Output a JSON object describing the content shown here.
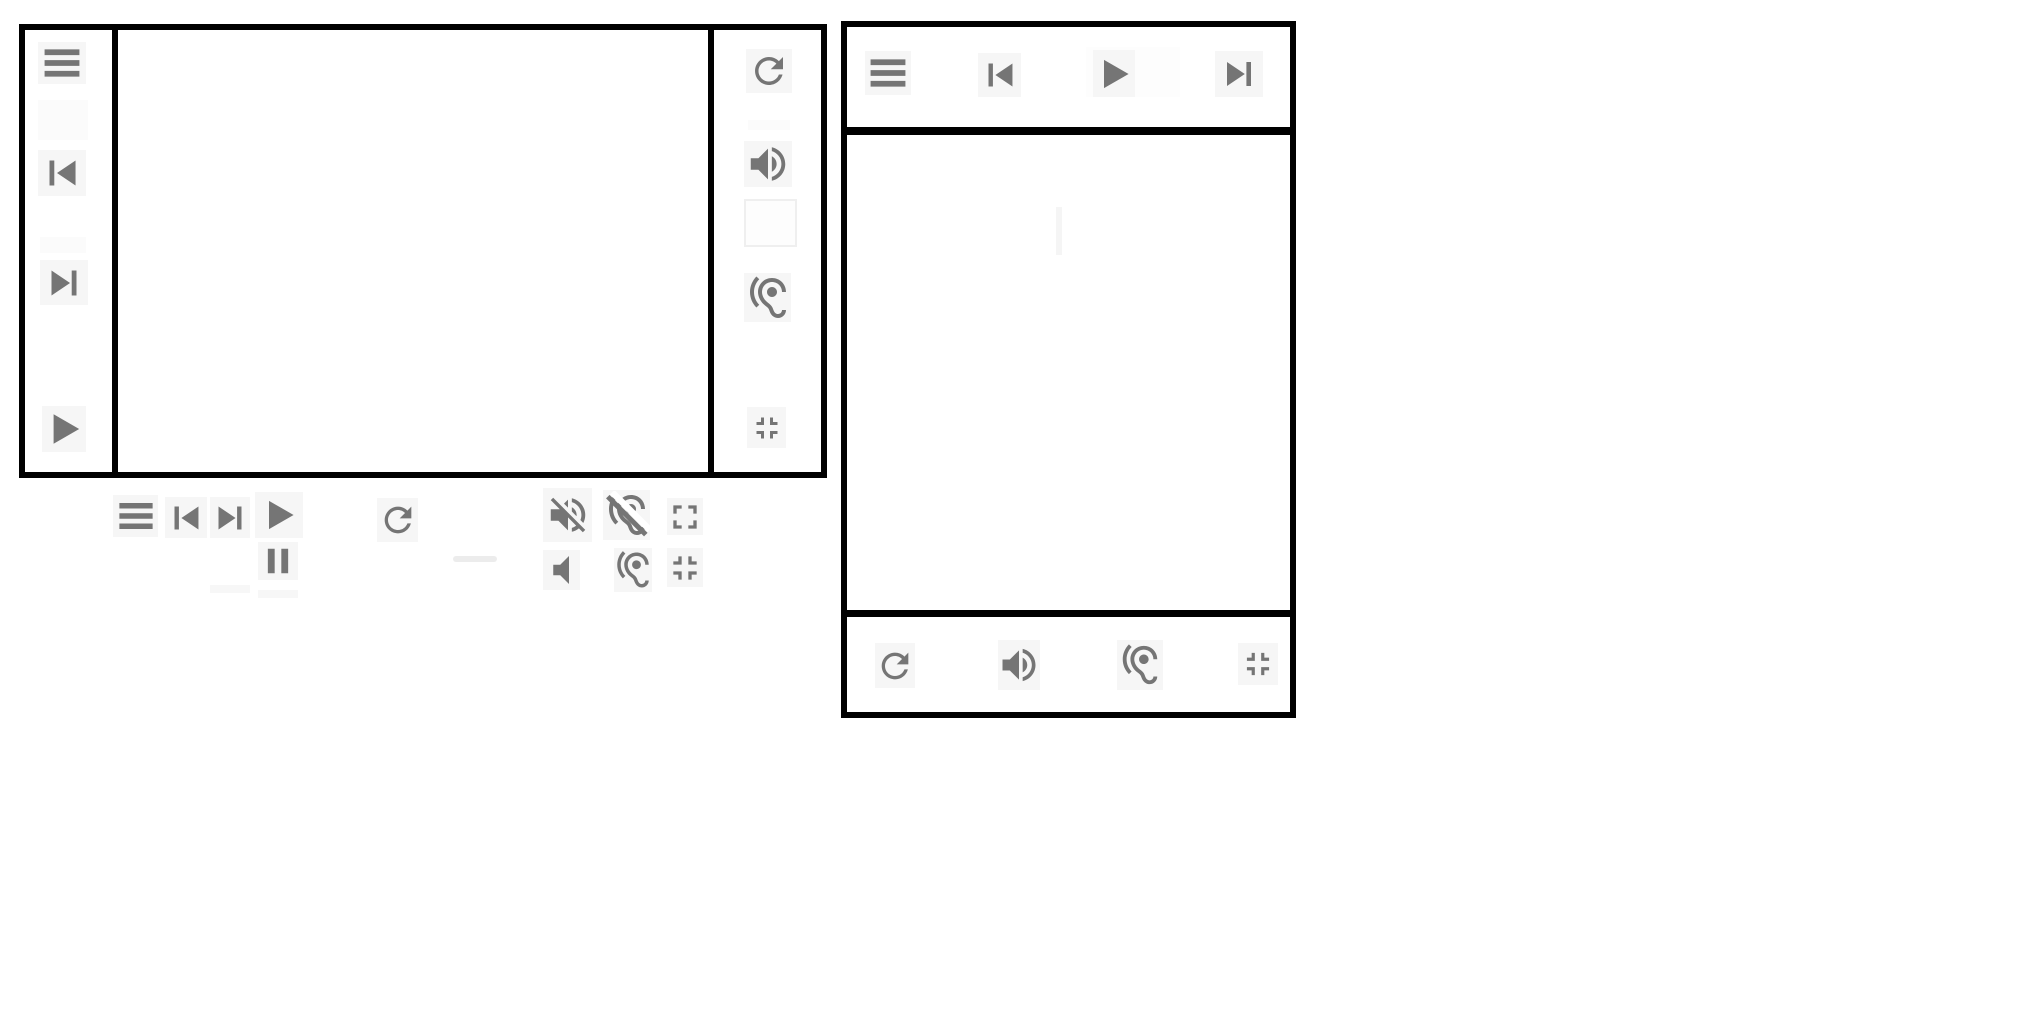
{
  "app": {
    "description": "Two bordered media player panels with gray control icons and a floating control cluster",
    "visible_text": []
  },
  "colors": {
    "background": "#ffffff",
    "panel_border": "#000000",
    "icon": "#757575",
    "button_tile": "#f6f6f6",
    "empty_tile": "#fdfdfd",
    "empty_tile_edge": "#efefef",
    "artifact_tile": "#f7f7f7",
    "faint_tile": "#fbfbfb",
    "dash": "#ececec",
    "faint_line": "#f5f5f5"
  },
  "left_player": {
    "name": "left-player-panel",
    "left_toolbar": {
      "name": "left-toolbar",
      "buttons": [
        {
          "id": "lp-menu",
          "icon": "menu",
          "name": "menu-button"
        },
        {
          "id": "lp-prev",
          "icon": "skip-previous",
          "name": "skip-previous-button"
        },
        {
          "id": "lp-next",
          "icon": "skip-next",
          "name": "skip-next-button"
        },
        {
          "id": "lp-play",
          "icon": "play",
          "name": "play-button"
        }
      ]
    },
    "right_toolbar": {
      "name": "right-toolbar",
      "buttons": [
        {
          "id": "rp-refresh",
          "icon": "refresh",
          "name": "refresh-button"
        },
        {
          "id": "rp-volume",
          "icon": "volume-up",
          "name": "volume-up-button"
        },
        {
          "id": "rp-empty",
          "icon": "none",
          "name": "empty-button"
        },
        {
          "id": "rp-hearing",
          "icon": "hearing",
          "name": "hearing-button"
        },
        {
          "id": "rp-collapse",
          "icon": "fullscreen-exit",
          "name": "fullscreen-exit-button"
        }
      ]
    }
  },
  "floating_controls": {
    "name": "floating-controls",
    "row1": [
      {
        "id": "f-menu",
        "icon": "menu",
        "name": "menu-button"
      },
      {
        "id": "f-prev",
        "icon": "skip-previous",
        "name": "skip-previous-button"
      },
      {
        "id": "f-next",
        "icon": "skip-next",
        "name": "skip-next-button"
      },
      {
        "id": "f-play",
        "icon": "play",
        "name": "play-button"
      },
      {
        "id": "f-refresh",
        "icon": "refresh",
        "name": "refresh-button"
      },
      {
        "id": "f-voloff",
        "icon": "volume-off",
        "name": "volume-off-button"
      },
      {
        "id": "f-hearoff",
        "icon": "hearing-disabled",
        "name": "hearing-disabled-button"
      },
      {
        "id": "f-fullscreen",
        "icon": "fullscreen",
        "name": "fullscreen-button"
      }
    ],
    "row2": [
      {
        "id": "f-pause",
        "icon": "pause",
        "name": "pause-button"
      },
      {
        "id": "f-volmute",
        "icon": "volume-mute",
        "name": "volume-mute-button"
      },
      {
        "id": "f-hearing",
        "icon": "hearing",
        "name": "hearing-button"
      },
      {
        "id": "f-collapse",
        "icon": "fullscreen-exit",
        "name": "fullscreen-exit-button"
      }
    ]
  },
  "right_player": {
    "name": "right-player-panel",
    "top_toolbar": {
      "name": "top-toolbar",
      "buttons": [
        {
          "id": "rt-menu",
          "icon": "menu",
          "name": "menu-button"
        },
        {
          "id": "rt-prev",
          "icon": "skip-previous",
          "name": "skip-previous-button"
        },
        {
          "id": "rt-play",
          "icon": "play",
          "name": "play-button"
        },
        {
          "id": "rt-next",
          "icon": "skip-next",
          "name": "skip-next-button"
        }
      ]
    },
    "bottom_toolbar": {
      "name": "bottom-toolbar",
      "buttons": [
        {
          "id": "rb-refresh",
          "icon": "refresh",
          "name": "refresh-button"
        },
        {
          "id": "rb-volume",
          "icon": "volume-up",
          "name": "volume-up-button"
        },
        {
          "id": "rb-hearing",
          "icon": "hearing",
          "name": "hearing-button"
        },
        {
          "id": "rb-collapse",
          "icon": "fullscreen-exit",
          "name": "fullscreen-exit-button"
        }
      ]
    }
  },
  "artifacts": [
    {
      "id": "a-tile-1",
      "name": "ui-artifact-tile"
    },
    {
      "id": "a-tile-2",
      "name": "ui-artifact-tile"
    },
    {
      "id": "a-strip-1",
      "name": "ui-artifact-strip"
    },
    {
      "id": "a-play-backing",
      "name": "ui-artifact-tile"
    },
    {
      "id": "a-dash",
      "name": "ui-artifact-dash"
    },
    {
      "id": "a-rem-1",
      "name": "ui-artifact-strip"
    },
    {
      "id": "a-rem-2",
      "name": "ui-artifact-strip"
    },
    {
      "id": "a-vline",
      "name": "ui-artifact-line"
    }
  ]
}
